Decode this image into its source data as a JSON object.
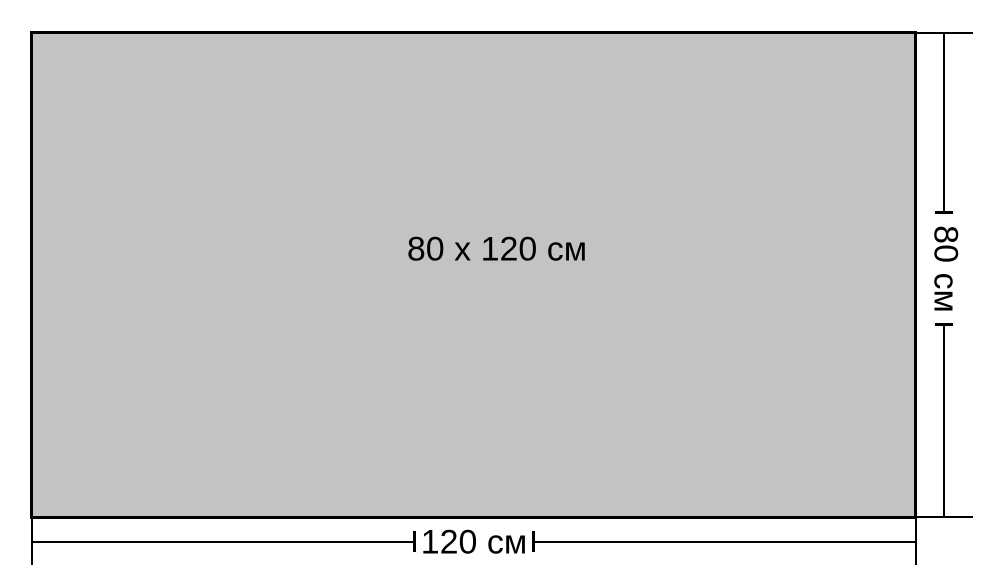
{
  "diagram": {
    "panel": {
      "size_label": "80 x 120 см",
      "fill_color": "#c3c3c3",
      "border_color": "#000000"
    },
    "dimensions": {
      "height": {
        "label": "80 см",
        "value": 80,
        "unit": "см",
        "orientation": "vertical",
        "position": "right"
      },
      "width": {
        "label": "120 см",
        "value": 120,
        "unit": "см",
        "orientation": "horizontal",
        "position": "bottom"
      }
    },
    "background_color": "#ffffff",
    "line_color": "#000000"
  }
}
